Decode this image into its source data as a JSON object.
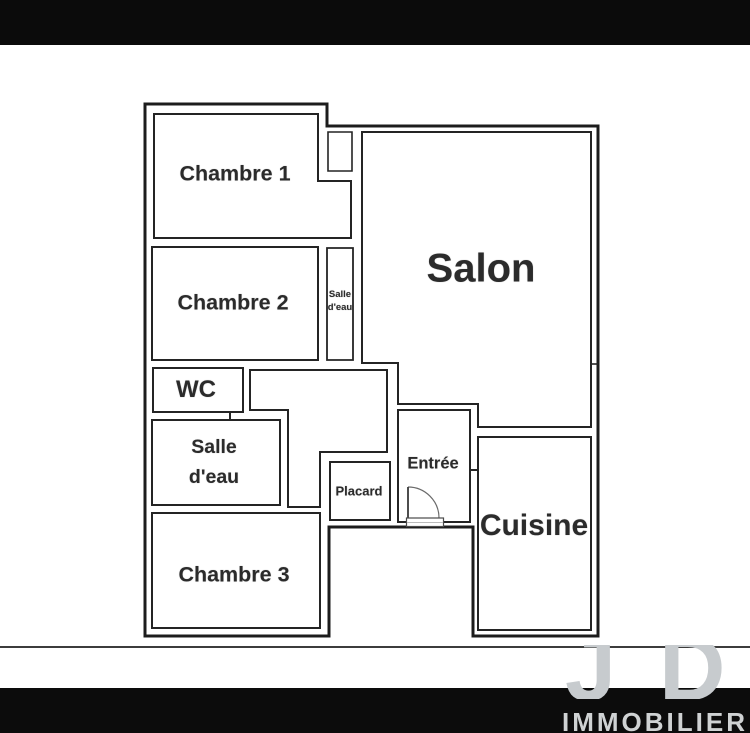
{
  "colors": {
    "top_bar": "#0b0b0b",
    "bottom_bar": "#0c0c0c",
    "wall": "#1c1c1c",
    "room_border": "#242424",
    "label_text": "#2b2b2b",
    "ground_line": "#3c3c3c",
    "watermark_letters": "#c7cbce",
    "brand_text": "#cfd2d3"
  },
  "floorplan": {
    "rooms": [
      {
        "id": "chambre-1",
        "label": "Chambre 1"
      },
      {
        "id": "chambre-2",
        "label": "Chambre 2"
      },
      {
        "id": "salle-eau-petite",
        "lines": [
          "Salle",
          "d'eau"
        ]
      },
      {
        "id": "salon",
        "label": "Salon"
      },
      {
        "id": "wc",
        "label": "WC"
      },
      {
        "id": "salle-eau",
        "lines": [
          "Salle",
          "d'eau"
        ]
      },
      {
        "id": "chambre-3",
        "label": "Chambre 3"
      },
      {
        "id": "placard",
        "label": "Placard"
      },
      {
        "id": "entree",
        "label": "Entrée"
      },
      {
        "id": "cuisine",
        "label": "Cuisine"
      }
    ]
  },
  "watermark": {
    "logo_letters": [
      "J",
      "D"
    ],
    "brand": "IMMOBILIER"
  }
}
